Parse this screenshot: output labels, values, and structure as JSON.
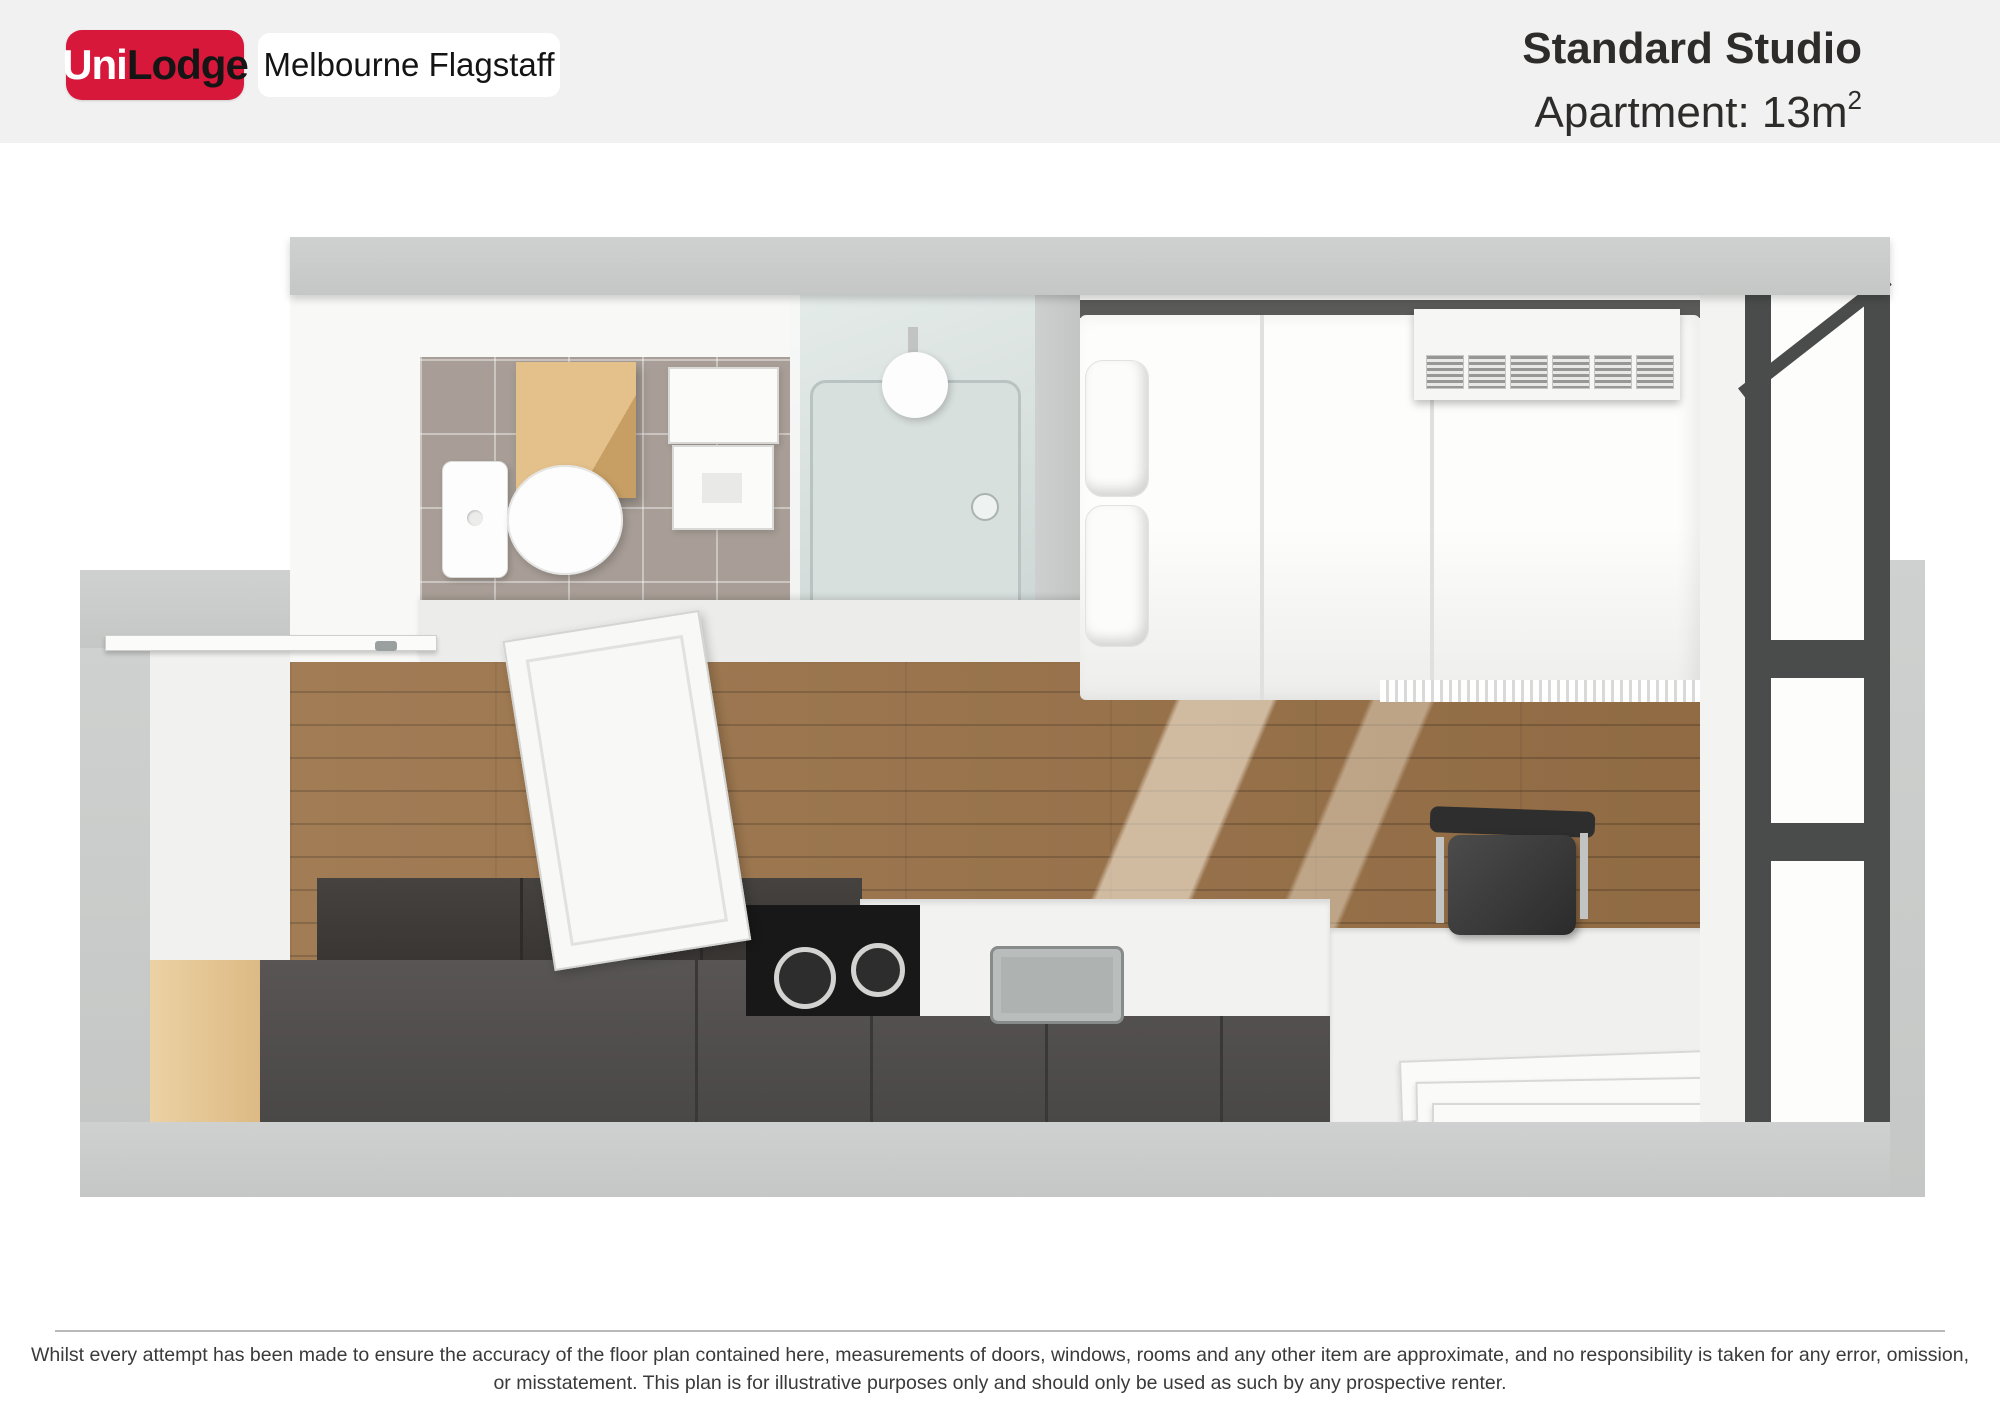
{
  "header": {
    "logo": {
      "uni": "Uni",
      "lodge": "Lodge"
    },
    "property_name": "Melbourne Flagstaff",
    "title": "Standard Studio",
    "subtitle_prefix": "Apartment: 13m",
    "subtitle_sup": "2"
  },
  "footer": {
    "disclaimer_line1": "Whilst every attempt has been made to ensure the accuracy of the floor plan contained here, measurements of doors, windows, rooms and any other item are approximate, and no responsibility is taken for any error, omission,",
    "disclaimer_line2": "or misstatement. This plan is for illustrative purposes only and should only be used as such by any prospective renter."
  },
  "colors": {
    "brand_red": "#D7183B",
    "header_bg": "#F1F1F2",
    "wall_gray": "#C9CBCA",
    "timber_floor": "#9A7248",
    "oak_cabinet": "#DDBA84",
    "tile_floor": "#A89E97",
    "dark_cabinet": "#4D4A49",
    "window_frame": "#4A4B4B",
    "shower_glass": "#D8E0DE"
  },
  "floorplan": {
    "view": "top-down 3D render of studio apartment",
    "elements": [
      "entry-door",
      "toilet",
      "vanity-cabinet",
      "wall-basin",
      "shower-enclosure",
      "double-bed",
      "pillows",
      "air-conditioner",
      "desk",
      "desk-chair",
      "kitchen-bench",
      "oven-cooktop",
      "kitchen-sink",
      "dark-cabinets",
      "leaning-panels",
      "balcony-window",
      "timber-floor",
      "tiled-floor"
    ]
  }
}
